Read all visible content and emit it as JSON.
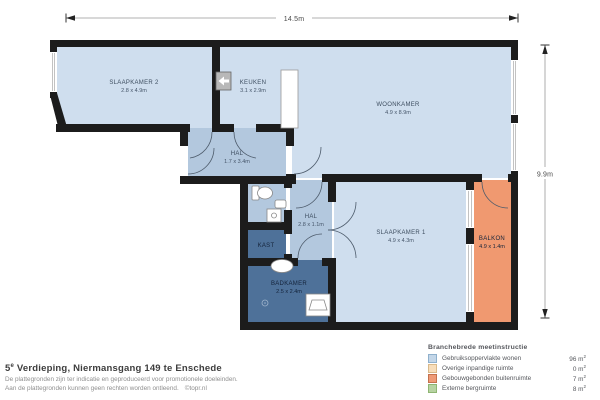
{
  "plan": {
    "width_label": "14.5m",
    "height_label": "9.9m",
    "rooms": [
      {
        "name": "SLAAPKAMER 2",
        "size": "2.8 x 4.9m"
      },
      {
        "name": "KEUKEN",
        "size": "3.1 x 2.9m"
      },
      {
        "name": "WOONKAMER",
        "size": "4.9 x 8.9m"
      },
      {
        "name": "HAL",
        "size": "1.7 x 3.4m"
      },
      {
        "name": "HAL",
        "size": "2.8 x 1.1m"
      },
      {
        "name": "KAST"
      },
      {
        "name": "BADKAMER",
        "size": "2.5 x 2.4m"
      },
      {
        "name": "SLAAPKAMER 1",
        "size": "4.9 x 4.3m"
      },
      {
        "name": "BALKON",
        "size": "4.9 x 1.4m"
      }
    ],
    "colors": {
      "room_light": "#cfdeee",
      "hall": "#b3c8de",
      "wet_rooms": "#4e7199",
      "balcony": "#f09970",
      "wall": "#1c1c1c"
    }
  },
  "footer": {
    "address_number": "5",
    "address_sup": "e",
    "address_rest": " Verdieping, Niermansgang 149 te Enschede",
    "disclaimer_line1": "De plattegronden zijn ter indicatie en geproduceerd voor promotionele doeleinden.",
    "disclaimer_line2": "Aan de plattegronden kunnen geen rechten worden ontleend.",
    "credit": "©topr.nl"
  },
  "legend": {
    "title": "Branchebrede meetinstructie",
    "unit": "m",
    "unit_sup": "2",
    "items": [
      {
        "label": "Gebruiksoppervlakte wonen",
        "value": "96",
        "color": "#c3d6e8"
      },
      {
        "label": "Overige inpandige ruimte",
        "value": "0",
        "color": "#f7ddba"
      },
      {
        "label": "Gebouwgebonden buitenruimte",
        "value": "7",
        "color": "#ef9a76"
      },
      {
        "label": "Externe bergruimte",
        "value": "8",
        "color": "#b7d3a2"
      }
    ]
  }
}
